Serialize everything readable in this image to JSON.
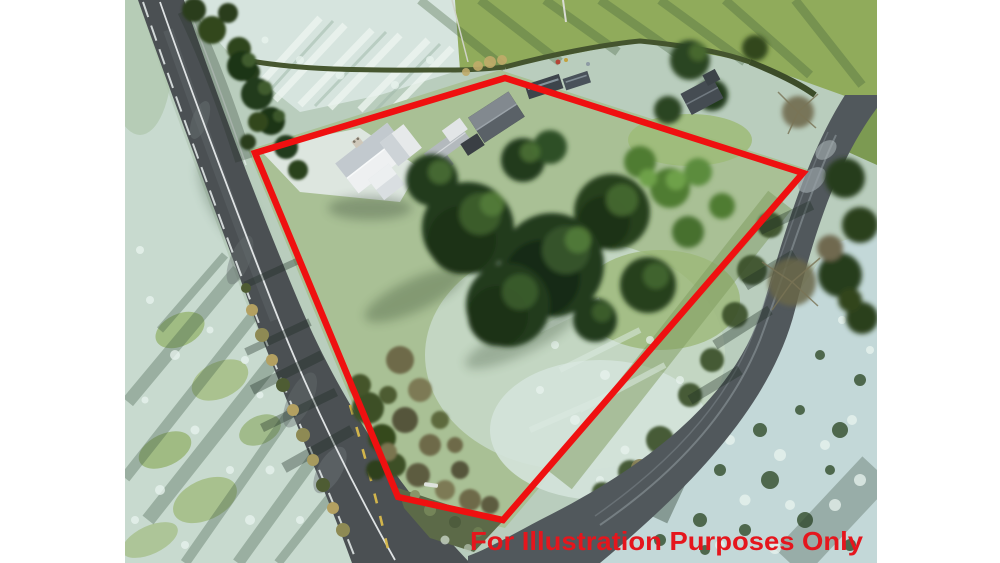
{
  "canvas": {
    "background_color": "#ffffff"
  },
  "photo": {
    "kind": "aerial-drone-photograph",
    "season": "winter-frost-low-sun",
    "features": {
      "main_road": "country road running from top-left to bottom-centre",
      "side_road": "lane curving from the right down to a junction at bottom",
      "cottage": "white two-storey cottage with grey roof",
      "dark_shed": "dark shed with grey gabled roof",
      "garden_sheds": "small garden sheds beyond top hedge",
      "conifers": "large conifer trees in the centre of the site",
      "fields": "frost-covered pasture fields with long tree shadows",
      "hedgerows": "hedgerows and tree lines along the roads"
    }
  },
  "annotation": {
    "watermark": "For Illustration Purposes Only",
    "watermark_color": "#e5161d",
    "boundary_color": "#ef1010",
    "boundary_stroke_px": 6.5,
    "boundary_points": "505,78 803,173 503,520 398,497 255,153"
  }
}
